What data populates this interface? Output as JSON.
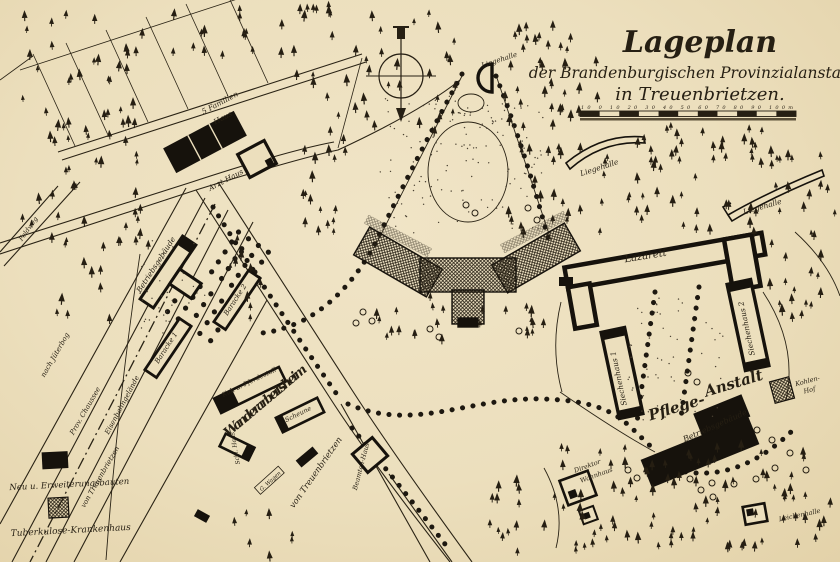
{
  "map": {
    "title": {
      "line1": "Lageplan",
      "line2": "der Brandenburgischen Provinzialanstalten",
      "line3": "in Treuenbrietzen."
    },
    "scale_bar": {
      "ticks": "10 0 10 20 30 40 50 60 70 80 90 100m"
    },
    "colors": {
      "paper": "#ecdfbd",
      "ink": "#261f13"
    },
    "labels": {
      "liegehalle_top": "Liegehalle",
      "liegehalle_mid": "Liegehalle",
      "liegehalle_right": "Liegehalle",
      "lazarett": "Lazarett",
      "siechenhaus1": "Siechenhaus 1",
      "siechenhaus2": "Siechenhaus 2",
      "pflege1": "Pflege-",
      "pflege2": "Anstalt",
      "kohlen1": "Kohlen-",
      "kohlen2": "Hof",
      "betriebsgebaeude_right": "Betriebsgebäude",
      "direktor1": "Direktor",
      "direktor2": "Wohnhaus",
      "leichenhalle": "Leichenhalle",
      "betriebsgebaeude_left": "Betriebsgebäude",
      "baracke1": "Baracke 1",
      "baracke2": "Baracke 2",
      "kuh_pferdestall": "Kuh u. Pferdestall",
      "wanderarbeitsheim": "Wanderarbeitsheim",
      "scheune": "Scheune",
      "schl_haus": "Schl. Haus",
      "g_wagen": "G. Wagen",
      "beamten_haus": "Beamten-Haus",
      "five_familien1": "5 Familien",
      "five_familien2": "Haus",
      "arzt_haus": "Arzt-Haus",
      "feldweg": "Feldweg",
      "nach_jueterbog": "nach Jüterbog",
      "prov_chaussee": "Prov. Chaussee",
      "eisenbahngelaende": "Eisenbahngelände",
      "von_treuenbrietzen_left": "von Treuenbrietzen",
      "von_treuenbrietzen_center": "von Treuenbrietzen"
    },
    "legend": {
      "new_buildings": "Neu u. Erweiterungsbauten",
      "tb_hospital": "Tuberkulose-Krankenhaus"
    }
  }
}
